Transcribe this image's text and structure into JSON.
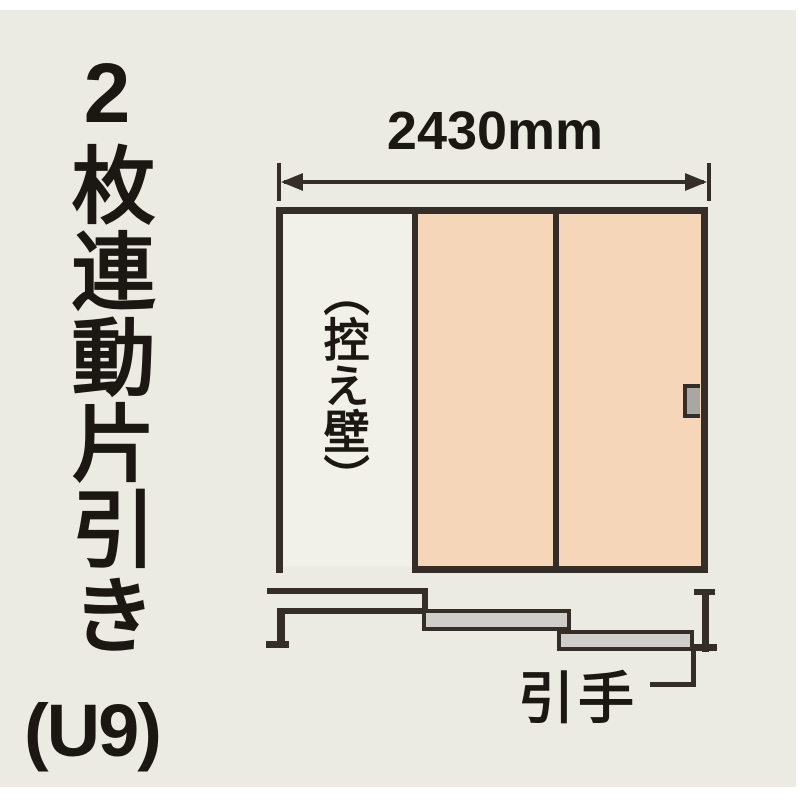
{
  "product": {
    "title": "2枚連動片引き",
    "code": "(U9)"
  },
  "dimension": {
    "width_label": "2430mm"
  },
  "elevation": {
    "pocket_wall_label": "（控え壁）"
  },
  "callout": {
    "handle_label": "引手"
  },
  "colors": {
    "background": "#ECEBE3",
    "pocket_area": "#F1F0E9",
    "door_panel": "#F6D6B9",
    "line": "#352E28",
    "plan_door_fill": "#D0CECB",
    "handle_fill": "#A9A7A3"
  }
}
